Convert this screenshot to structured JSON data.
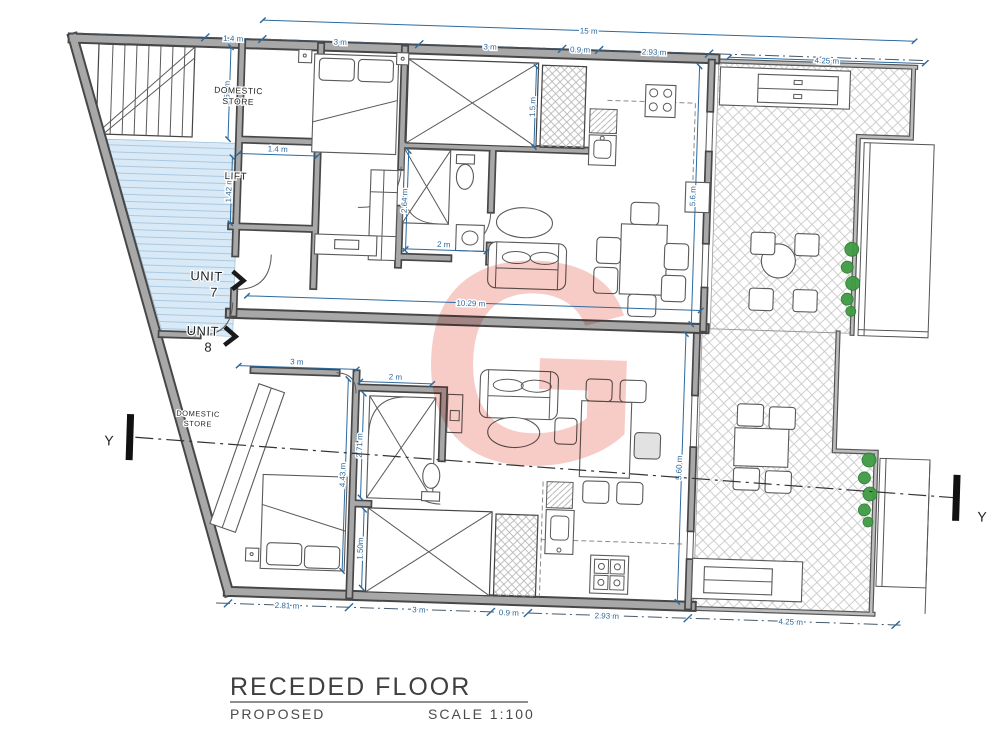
{
  "title_block": {
    "title": "RECEDED FLOOR",
    "status": "PROPOSED",
    "scale": "SCALE 1:100"
  },
  "watermark": {
    "letter": "G",
    "color": "#f2a9a1"
  },
  "labels": {
    "domestic1": "DOMESTIC",
    "domestic2": "STORE",
    "lift": "LIFT",
    "unit": "UNIT",
    "n7": "7",
    "n8": "8",
    "y": "Y"
  },
  "dims": {
    "t15": "15 m",
    "t1": "1.4 m",
    "t2": "3 m",
    "t3": "3 m",
    "t4": "0.9 m",
    "t5": "2.93 m",
    "t425": "4.25 m",
    "b1": "2.81 m",
    "b2": "3 m",
    "b3": "0.9 m",
    "b4": "2.93 m",
    "b425": "4.25 m",
    "u7_store": "1.56 m",
    "u7_liftw": "1.4 m",
    "u7_liftd": "1.42 m",
    "u7_shaft": "1.5 m",
    "u7_bathd": "2.64 m",
    "u7_bathw": "2 m",
    "u7_party": "10.29 m",
    "u7_depth": "5.6 m",
    "u8_bedw": "3 m",
    "u8_livw": "2 m",
    "u8_bathd": "2.71 m",
    "u8_bedd": "4.43 m",
    "u8_shaft": "1.50m",
    "u8_depth": "5.60 m"
  },
  "colors": {
    "dimension": "#2c6aa0",
    "wall_outline": "#474747",
    "wall_fill": "#a8a8a8",
    "corridor": "#d9eaf6",
    "watermark": "#f2a9a1",
    "plants": "#3f9b43"
  }
}
